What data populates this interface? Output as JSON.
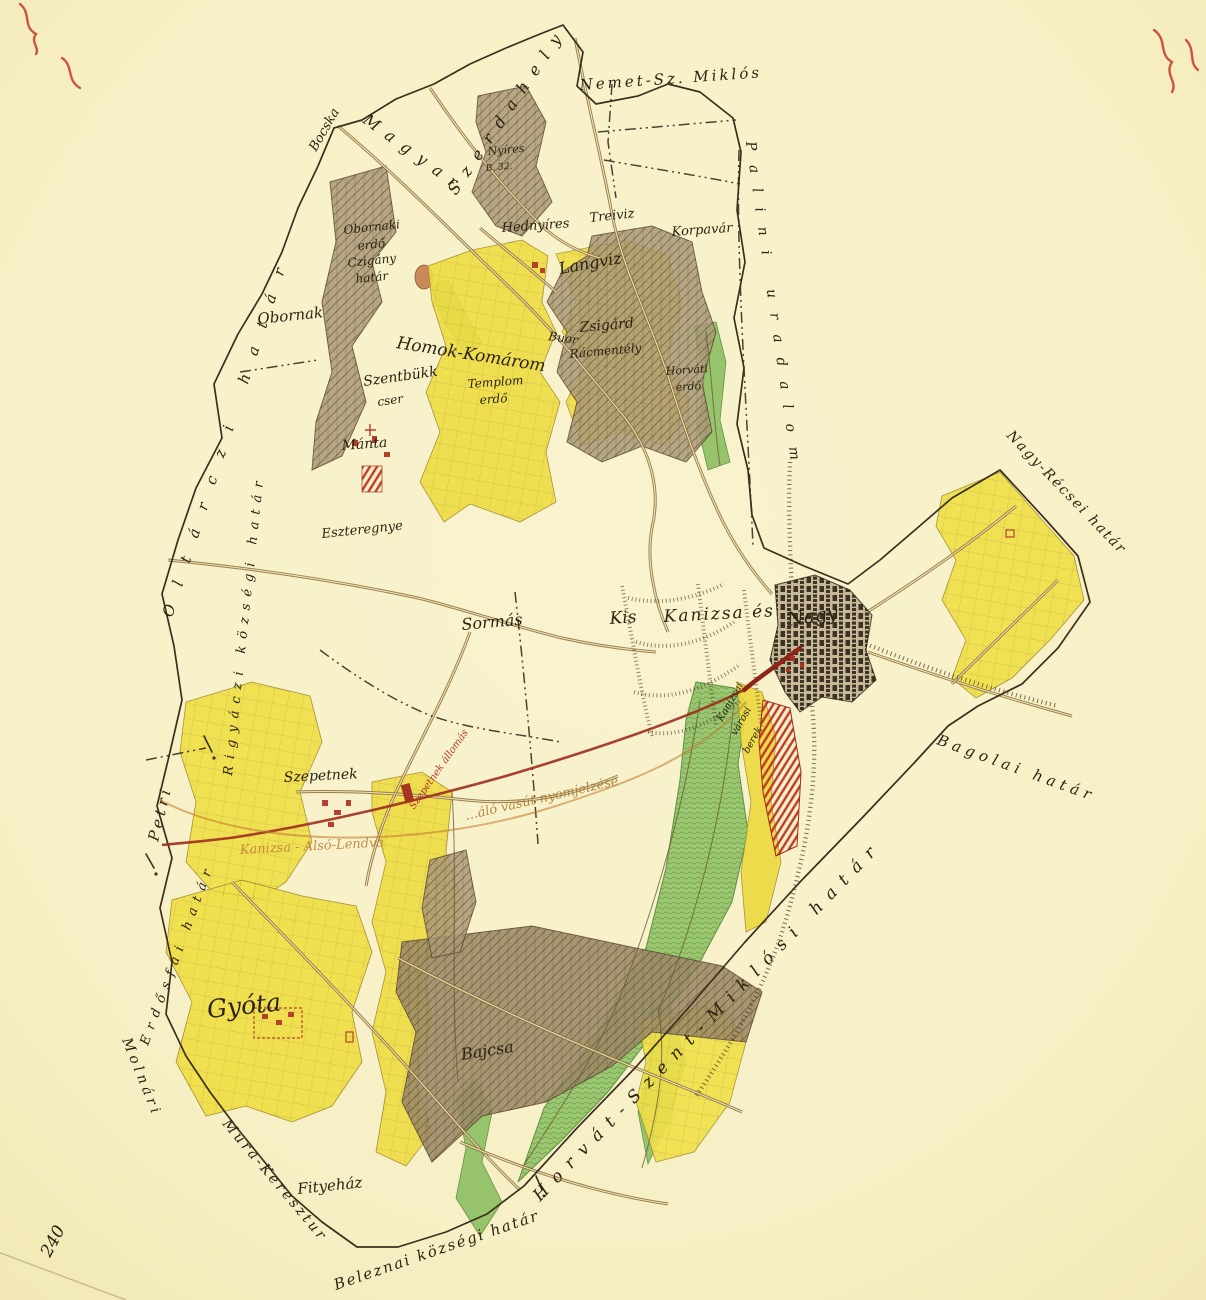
{
  "artifact": {
    "type": "hand-drawn cadastral boundary map of Nagykanizsa and surroundings",
    "corner_number": "240"
  },
  "colors": {
    "paper": "#f7f0c6",
    "field_yellow": "#efdd43",
    "meadow_green": "#8cbf62",
    "forest_brown": "#ab9a78",
    "ink": "#2c2212",
    "boundary_ink": "#3a2f1e",
    "road_brown": "#8a6b36",
    "planned_railway_red": "#9e2c1e",
    "station_red": "#b5402f",
    "survey_orange": "#bd7a35"
  },
  "map": {
    "labels": [
      {
        "id": "corner-number",
        "text": "240"
      },
      {
        "id": "bocska",
        "text": "Bocska"
      },
      {
        "id": "magyar",
        "text": "Magyar"
      },
      {
        "id": "szerdahely",
        "text": "Szerdahely"
      },
      {
        "id": "nemet-sz-miklos",
        "text": "Nemet-Sz. Miklós"
      },
      {
        "id": "palini-uradalom",
        "text": "Palini uradalom"
      },
      {
        "id": "oltarczi-hatar",
        "text": "Oltárczi határ"
      },
      {
        "id": "rigyaczi-kozsegi-hatar",
        "text": "Rigyáczi községi határ"
      },
      {
        "id": "petri",
        "text": "Petri"
      },
      {
        "id": "erdosfai-hatar",
        "text": "Erdősfai határ"
      },
      {
        "id": "molnari",
        "text": "Molnári"
      },
      {
        "id": "mura-keresztur",
        "text": "Mura-Keresztur"
      },
      {
        "id": "fityehaz",
        "text": "Fityeház"
      },
      {
        "id": "beleznai-kozsegi-hatar",
        "text": "Beleznai községi határ"
      },
      {
        "id": "horvat-szent-miklosi-hatar",
        "text": "Horvát-Szent-Miklósi határ"
      },
      {
        "id": "bagolai-hatar",
        "text": "Bagolai határ"
      },
      {
        "id": "nagy-recsei-hatar",
        "text": "Nagy-Récsei határ"
      },
      {
        "id": "obornak",
        "text": "Obornak"
      },
      {
        "id": "obornaki-erdo-line1",
        "text": "Obornaki"
      },
      {
        "id": "obornaki-erdo-line2",
        "text": "erdő"
      },
      {
        "id": "czigany-line1",
        "text": "Czigány"
      },
      {
        "id": "czigany-line2",
        "text": "határ"
      },
      {
        "id": "nyires",
        "text": "Nyíres"
      },
      {
        "id": "nyires-b",
        "text": "B. 32."
      },
      {
        "id": "hednyires",
        "text": "Hednyíres"
      },
      {
        "id": "treiviz",
        "text": "Treiviz"
      },
      {
        "id": "langviz",
        "text": "Langviz"
      },
      {
        "id": "korpavar",
        "text": "Korpavár"
      },
      {
        "id": "homok-komarom",
        "text": "Homok-Komárom"
      },
      {
        "id": "buor",
        "text": "Buor"
      },
      {
        "id": "zsigard",
        "text": "Zsigárd"
      },
      {
        "id": "racmently",
        "text": "Rácmentély"
      },
      {
        "id": "horvati-erdo-line1",
        "text": "Horváti"
      },
      {
        "id": "horvati-erdo-line2",
        "text": "erdő"
      },
      {
        "id": "szentbukk",
        "text": "Szentbükk"
      },
      {
        "id": "cser",
        "text": "cser"
      },
      {
        "id": "templom",
        "text": "Templom"
      },
      {
        "id": "templom-erdo",
        "text": "erdő"
      },
      {
        "id": "manta",
        "text": "Mánta"
      },
      {
        "id": "eszteregnye",
        "text": "Eszteregnye"
      },
      {
        "id": "sormas",
        "text": "Sormás"
      },
      {
        "id": "kis",
        "text": "Kis"
      },
      {
        "id": "kanizsa-es",
        "text": "Kanizsa és"
      },
      {
        "id": "nagy",
        "text": "Nagy"
      },
      {
        "id": "berek-line1",
        "text": "Kanizsai"
      },
      {
        "id": "berek-line2",
        "text": "városi"
      },
      {
        "id": "berek-line3",
        "text": "berek"
      },
      {
        "id": "szepetnek",
        "text": "Szepetnek"
      },
      {
        "id": "szepetnek-allomas",
        "text": "Szepetnek állomás"
      },
      {
        "id": "kanizsa-also-lendva",
        "text": "Kanizsa - Alsó-Lendva"
      },
      {
        "id": "vasut-nyomjelzese",
        "text": "…áló vasút nyomjelzése"
      },
      {
        "id": "gyota",
        "text": "Gyóta"
      },
      {
        "id": "bajcsa",
        "text": "Bajcsa"
      }
    ]
  }
}
